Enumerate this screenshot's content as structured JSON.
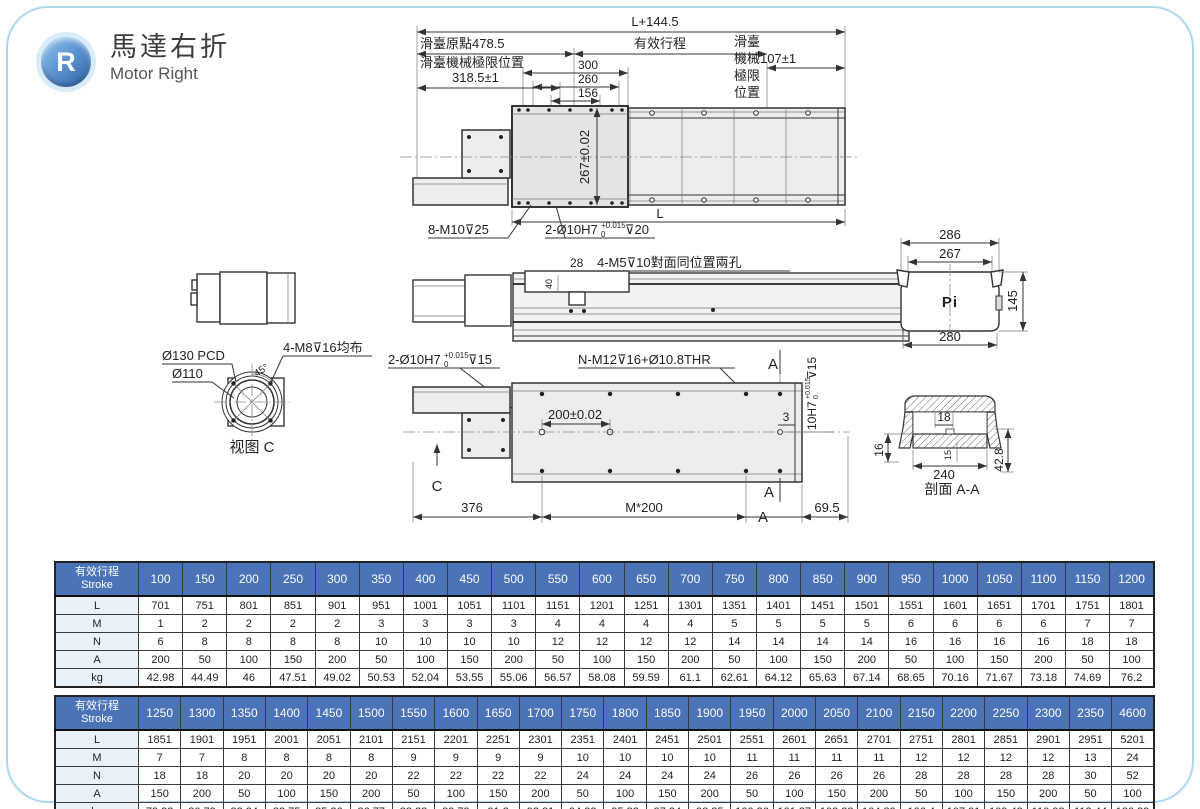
{
  "colors": {
    "accent": "#4a73b8",
    "frame_border": "#a9d6ec",
    "badge_dark": "#2e62a8",
    "badge_light": "#96c7ec"
  },
  "header": {
    "badge": "R",
    "title_zh": "馬達右折",
    "title_en": "Motor Right"
  },
  "d": {
    "fv": {
      "total": "L+144.5",
      "origin": "滑臺原點478.5",
      "stroke": "有效行程",
      "mech1": "滑臺機械極限位置",
      "mech2": "318.5±1",
      "d300": "300",
      "d260": "260",
      "d156": "156",
      "h": "267±0.02",
      "r1": "滑臺",
      "r2": "機械107±1",
      "r3": "極限",
      "r4": "位置",
      "tap": "8-M10⊽25",
      "dw_base": "2-Ø10H7",
      "dw_sup": "+0.015",
      "dw_sub": "0",
      "dw_tail": "⊽20",
      "L": "L"
    },
    "sv": {
      "d28": "28",
      "holes": "4-M5⊽10對面同位置兩孔",
      "d40": "40"
    },
    "ev": {
      "d286": "286",
      "d267": "267",
      "d280": "280",
      "d145": "145",
      "logo": "Pi"
    },
    "mv": {
      "pcd": "Ø130 PCD",
      "bore": "Ø110",
      "bolts": "4-M8⊽16均布",
      "angle": "45°",
      "caption": "视图 C"
    },
    "pv": {
      "dw_base": "2-Ø10H7",
      "dw_sup": "+0.015",
      "dw_sub": "0",
      "dw_tail": "⊽15",
      "mount": "N-M12⊽16+Ø10.8THR",
      "d200": "200±0.02",
      "d3": "3",
      "sd_base": "10H7",
      "sd_sup": "+0.015",
      "sd_sub": "0",
      "sd_tail": "⊽15",
      "A": "A",
      "C": "C",
      "d376": "376",
      "pitch": "M*200",
      "d695": "69.5"
    },
    "xv": {
      "d18": "18",
      "d16": "16",
      "d240": "240",
      "d15": "15",
      "d428": "42.8",
      "caption": "剖面 A-A"
    }
  },
  "tables": [
    {
      "header_zh": "有效行程",
      "header_en": "Stroke",
      "strokes": [
        "100",
        "150",
        "200",
        "250",
        "300",
        "350",
        "400",
        "450",
        "500",
        "550",
        "600",
        "650",
        "700",
        "750",
        "800",
        "850",
        "900",
        "950",
        "1000",
        "1050",
        "1100",
        "1150",
        "1200"
      ],
      "rows": [
        {
          "label": "L",
          "values": [
            "701",
            "751",
            "801",
            "851",
            "901",
            "951",
            "1001",
            "1051",
            "1101",
            "1151",
            "1201",
            "1251",
            "1301",
            "1351",
            "1401",
            "1451",
            "1501",
            "1551",
            "1601",
            "1651",
            "1701",
            "1751",
            "1801"
          ]
        },
        {
          "label": "M",
          "values": [
            "1",
            "2",
            "2",
            "2",
            "2",
            "3",
            "3",
            "3",
            "3",
            "4",
            "4",
            "4",
            "4",
            "5",
            "5",
            "5",
            "5",
            "6",
            "6",
            "6",
            "6",
            "7",
            "7"
          ]
        },
        {
          "label": "N",
          "values": [
            "6",
            "8",
            "8",
            "8",
            "8",
            "10",
            "10",
            "10",
            "10",
            "12",
            "12",
            "12",
            "12",
            "14",
            "14",
            "14",
            "14",
            "16",
            "16",
            "16",
            "16",
            "18",
            "18"
          ]
        },
        {
          "label": "A",
          "values": [
            "200",
            "50",
            "100",
            "150",
            "200",
            "50",
            "100",
            "150",
            "200",
            "50",
            "100",
            "150",
            "200",
            "50",
            "100",
            "150",
            "200",
            "50",
            "100",
            "150",
            "200",
            "50",
            "100"
          ]
        },
        {
          "label": "kg",
          "values": [
            "42.98",
            "44.49",
            "46",
            "47.51",
            "49.02",
            "50.53",
            "52.04",
            "53.55",
            "55.06",
            "56.57",
            "58.08",
            "59.59",
            "61.1",
            "62.61",
            "64.12",
            "65.63",
            "67.14",
            "68.65",
            "70.16",
            "71.67",
            "73.18",
            "74.69",
            "76.2"
          ]
        }
      ]
    },
    {
      "header_zh": "有效行程",
      "header_en": "Stroke",
      "strokes": [
        "1250",
        "1300",
        "1350",
        "1400",
        "1450",
        "1500",
        "1550",
        "1600",
        "1650",
        "1700",
        "1750",
        "1800",
        "1850",
        "1900",
        "1950",
        "2000",
        "2050",
        "2100",
        "2150",
        "2200",
        "2250",
        "2300",
        "2350",
        "4600"
      ],
      "rows": [
        {
          "label": "L",
          "values": [
            "1851",
            "1901",
            "1951",
            "2001",
            "2051",
            "2101",
            "2151",
            "2201",
            "2251",
            "2301",
            "2351",
            "2401",
            "2451",
            "2501",
            "2551",
            "2601",
            "2651",
            "2701",
            "2751",
            "2801",
            "2851",
            "2901",
            "2951",
            "5201"
          ]
        },
        {
          "label": "M",
          "values": [
            "7",
            "7",
            "8",
            "8",
            "8",
            "8",
            "9",
            "9",
            "9",
            "9",
            "10",
            "10",
            "10",
            "10",
            "11",
            "11",
            "11",
            "11",
            "12",
            "12",
            "12",
            "12",
            "13",
            "24"
          ]
        },
        {
          "label": "N",
          "values": [
            "18",
            "18",
            "20",
            "20",
            "20",
            "20",
            "22",
            "22",
            "22",
            "22",
            "24",
            "24",
            "24",
            "24",
            "26",
            "26",
            "26",
            "26",
            "28",
            "28",
            "28",
            "28",
            "30",
            "52"
          ]
        },
        {
          "label": "A",
          "values": [
            "150",
            "200",
            "50",
            "100",
            "150",
            "200",
            "50",
            "100",
            "150",
            "200",
            "50",
            "100",
            "150",
            "200",
            "50",
            "100",
            "150",
            "200",
            "50",
            "100",
            "150",
            "200",
            "50",
            "100"
          ]
        },
        {
          "label": "kg",
          "values": [
            "79.22",
            "80.73",
            "82.24",
            "83.75",
            "85.26",
            "86.77",
            "88.28",
            "89.79",
            "91.3",
            "92.81",
            "94.32",
            "95.83",
            "97.34",
            "98.85",
            "100.36",
            "101.87",
            "103.38",
            "104.89",
            "106.4",
            "107.91",
            "109.42",
            "110.93",
            "112.44",
            "180.39"
          ]
        }
      ]
    }
  ]
}
